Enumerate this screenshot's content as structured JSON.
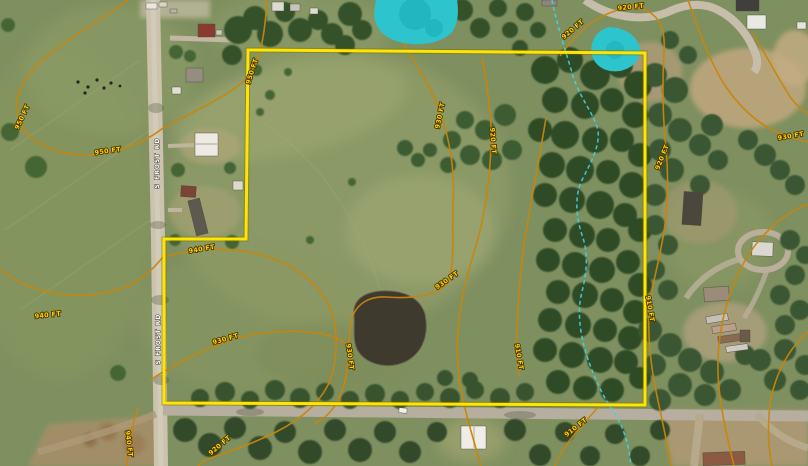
{
  "map": {
    "road_labels": [
      {
        "text": "S FROST RD"
      },
      {
        "text": "S FROST RD"
      }
    ],
    "contour_labels": [
      {
        "text": "950 FT"
      },
      {
        "text": "950 FT"
      },
      {
        "text": "950 FT"
      },
      {
        "text": "940 FT"
      },
      {
        "text": "940 FT"
      },
      {
        "text": "940 FT"
      },
      {
        "text": "930 FT"
      },
      {
        "text": "930 FT"
      },
      {
        "text": "930 FT"
      },
      {
        "text": "930 FT"
      },
      {
        "text": "920 FT"
      },
      {
        "text": "920 FT"
      },
      {
        "text": "910 FT"
      },
      {
        "text": "910 FT"
      },
      {
        "text": "920 FT"
      },
      {
        "text": "920 FT"
      },
      {
        "text": "920 FT"
      },
      {
        "text": "910 FT"
      },
      {
        "text": "930 FT"
      }
    ],
    "colors": {
      "parcel_boundary": "#ffe600",
      "contour_line": "#c8860a",
      "contour_label_fill": "#ffd400",
      "wetland_fill": "#2ec4ce",
      "stream_line": "#3fd6e8",
      "road_label_fill": "#ffffff"
    }
  }
}
